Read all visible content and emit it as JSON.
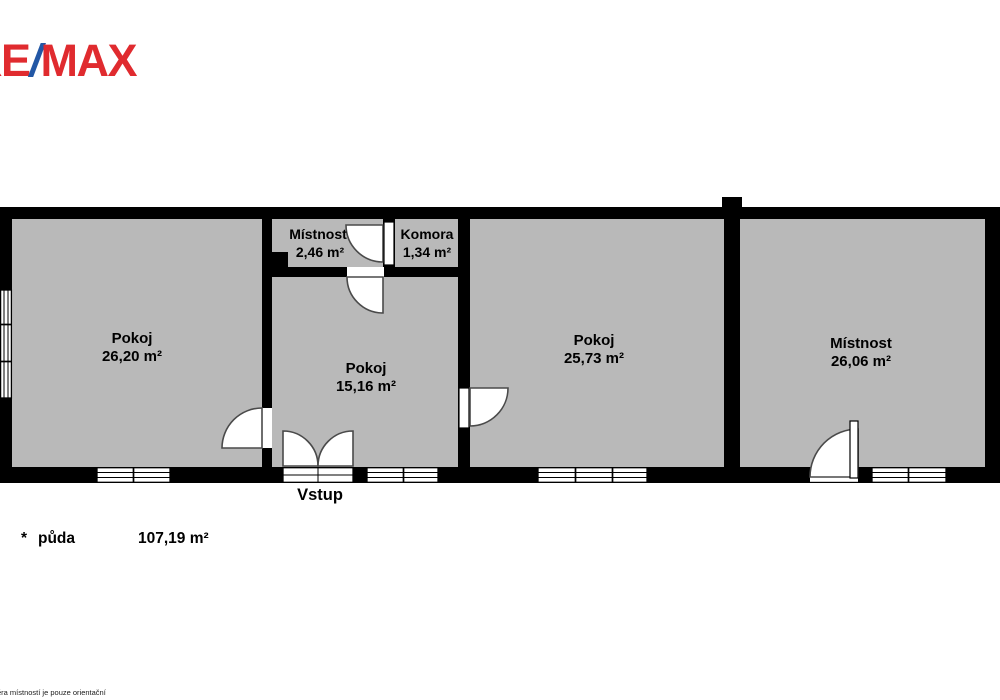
{
  "logo": {
    "re": "RE",
    "slash": "/",
    "max": "MAX"
  },
  "colors": {
    "background": "#ffffff",
    "room_fill": "#b9b9b9",
    "wall": "#000000",
    "logo_red": "#e02b2f",
    "logo_blue": "#2257a5"
  },
  "rooms": [
    {
      "id": "pokoj-left",
      "name": "Pokoj",
      "area": "26,20 m²"
    },
    {
      "id": "mistnost-small",
      "name": "Místnost",
      "area": "2,46 m²"
    },
    {
      "id": "komora",
      "name": "Komora",
      "area": "1,34 m²"
    },
    {
      "id": "pokoj-middle",
      "name": "Pokoj",
      "area": "15,16 m²"
    },
    {
      "id": "pokoj-right",
      "name": "Pokoj",
      "area": "25,73 m²"
    },
    {
      "id": "mistnost-big",
      "name": "Místnost",
      "area": "26,06 m²"
    }
  ],
  "entrance_label": "Vstup",
  "footnote": {
    "asterisk": "*",
    "label": "půda",
    "area": "107,19 m²"
  },
  "disclaimer": "ěra místností je pouze orientační"
}
